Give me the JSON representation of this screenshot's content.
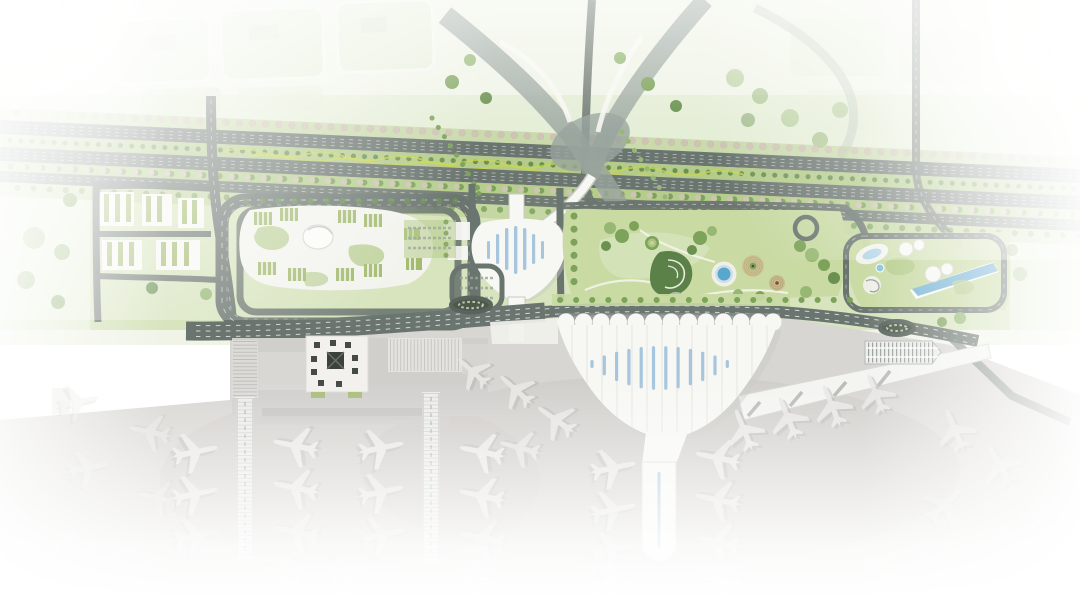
{
  "meta": {
    "alt": "Aerial architectural masterplan rendering of an airport precinct. A tree-lined multi-lane highway crosses the upper area past faded city blocks; landside loop roads enclose an office campus, a white tulip-shaped ground-transport centre, a landscaped park with circular gardens, a blue pond and a spiral garden, and a resort with swimming pools. A large white fan-shaped terminal with a rippled roof and blue skylights fronts the apron, where white aircraft park nose-in along piers. The rendering fades to white at all edges."
  },
  "palette": {
    "bg": "#ffffff",
    "washLight": "#f0f4e7",
    "washMid": "#e3ecd4",
    "lawn": "#c9daa3",
    "lawnDark": "#b4cb8b",
    "lawnLight": "#d9e5bf",
    "treeA": "#7da35a",
    "treeB": "#96b873",
    "treeC": "#6a9150",
    "treeBlossom": "#cfc3b4",
    "road": "#6b756f",
    "roadDark": "#59645e",
    "roadLight": "#98a49d",
    "lane": "#ffffff",
    "ribbon": "#c9d64f",
    "building": "#f7f7f4",
    "buildingShadow": "#c9cac3",
    "roofGreen": "#a3ba6f",
    "apron": "#d8d6d2",
    "apronShade": "#c6c4c0",
    "plane": "#e8e7e4",
    "planeShadow": "#b2b0ad",
    "poolBlue": "#7ab5d7",
    "pondBlue": "#58a7cf",
    "skylight": "#9abdd9",
    "gridDark": "#79807a",
    "parkTan": "#cfc594",
    "parkTanDark": "#b9ae7e",
    "swirlGreen": "#5c8148"
  },
  "scene": {
    "regions": [
      "city-blocks",
      "highway-corridor",
      "interchange",
      "residential-blocks",
      "office-campus",
      "transport-centre",
      "landscape-park",
      "resort-complex",
      "frontage-road",
      "left-terminal",
      "main-terminal",
      "satellite-pier",
      "right-concourse",
      "parking-garage",
      "apron"
    ],
    "aircraft_count": 41,
    "terminal_skylight_count": 12,
    "terminal_scallop_count": 13
  }
}
